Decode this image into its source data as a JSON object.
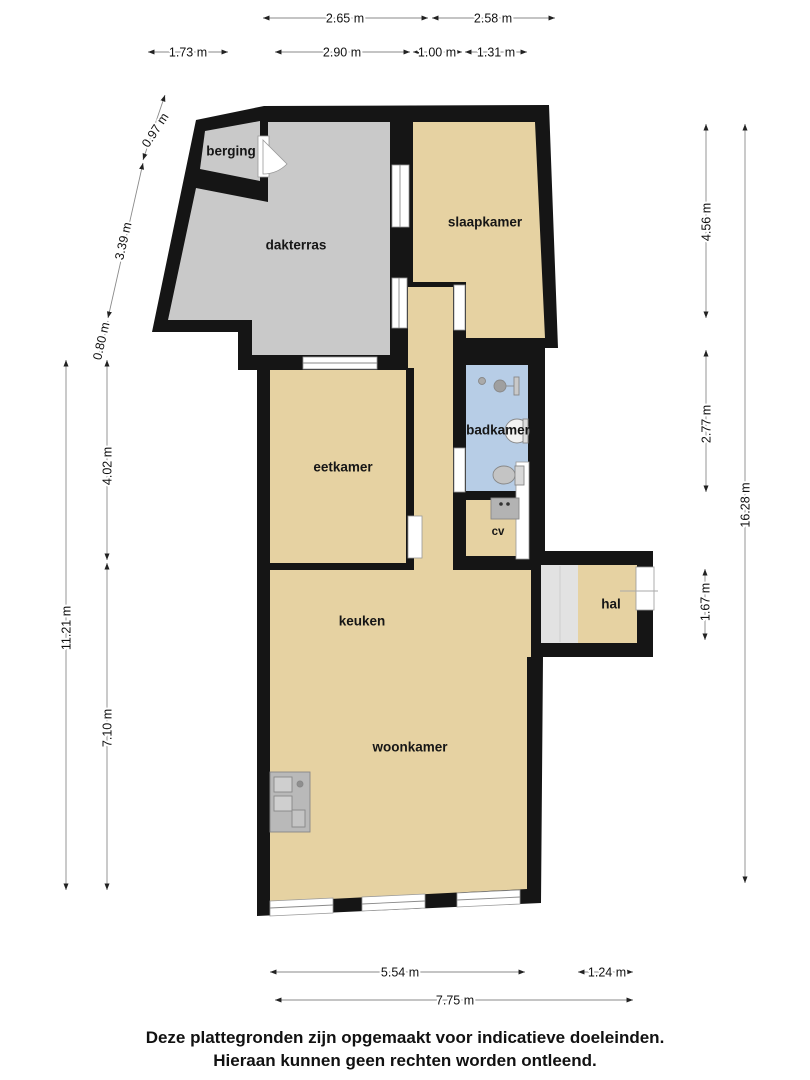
{
  "rooms": {
    "berging": "berging",
    "dakterras": "dakterras",
    "slaapkamer": "slaapkamer",
    "eetkamer": "eetkamer",
    "badkamer": "badkamer",
    "cv": "cv",
    "keuken": "keuken",
    "woonkamer": "woonkamer",
    "hal": "hal"
  },
  "dims": {
    "top_row1": [
      "2.65 m",
      "2.58 m"
    ],
    "top_row2": [
      "1.73 m",
      "2.90 m",
      "1.00 m",
      "1.31 m"
    ],
    "left": [
      "0.97 m",
      "3.39 m",
      "0.80 m",
      "4.02 m",
      "11.21 m",
      "7.10 m"
    ],
    "right": [
      "4.56 m",
      "2.77 m",
      "16.28 m",
      "1.67 m"
    ],
    "bottom": [
      "5.54 m",
      "1.24 m",
      "7.75 m"
    ]
  },
  "footer": {
    "line1": "Deze plattegronden zijn opgemaakt voor indicatieve doeleinden.",
    "line2": "Hieraan kunnen geen rechten worden ontleend."
  },
  "colors": {
    "wall": "#151515",
    "floor": "#e6d2a2",
    "terrace": "#c9c9c9",
    "bathroom": "#b7cde6",
    "landing": "#e2e2e2",
    "dimension_line": "#8a8a8a"
  }
}
